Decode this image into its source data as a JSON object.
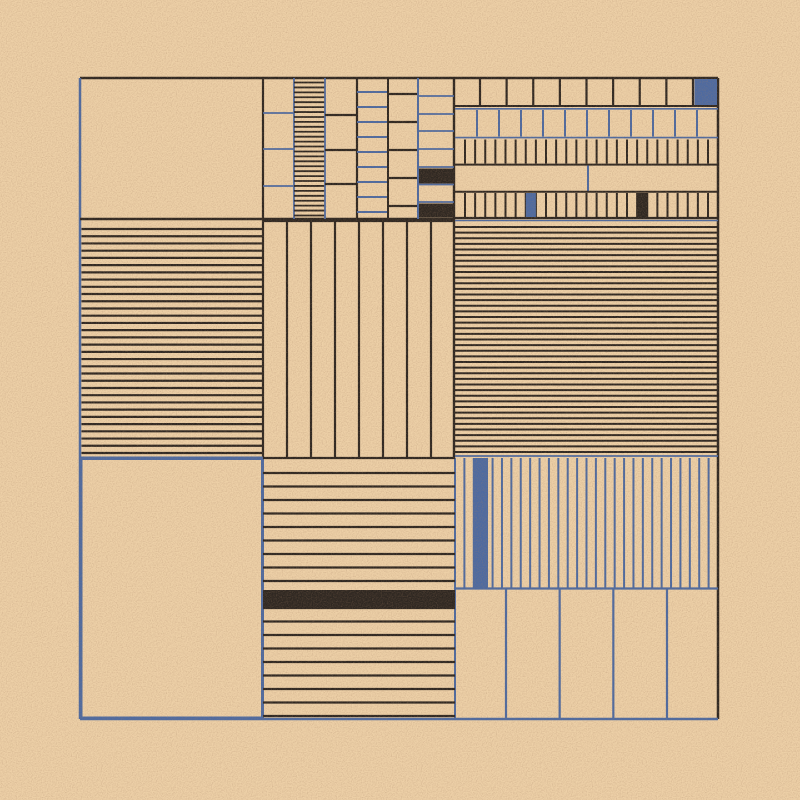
{
  "artwork": {
    "title": "generative-grid-composition",
    "width": 800,
    "height": 800,
    "background": "#edd0a7",
    "palette": {
      "ink": "#2e2721",
      "blue": "#4d6aa1",
      "bg": "#edd0a7"
    },
    "noise": {
      "base_frequency": 0.8,
      "opacity": 0.5
    },
    "shapes": [
      {
        "type": "line",
        "x1": 80,
        "y1": 78,
        "x2": 718,
        "y2": 78,
        "color": "ink",
        "t": 2.5
      },
      {
        "type": "line",
        "x1": 80,
        "y1": 78,
        "x2": 80,
        "y2": 719,
        "color": "blue",
        "t": 2.5
      },
      {
        "type": "line",
        "x1": 718,
        "y1": 78,
        "x2": 718,
        "y2": 719,
        "color": "ink",
        "t": 2.5
      },
      {
        "type": "line",
        "x1": 80,
        "y1": 719,
        "x2": 718,
        "y2": 719,
        "color": "blue",
        "t": 2.5
      },
      {
        "type": "line",
        "x1": 263,
        "y1": 78,
        "x2": 263,
        "y2": 458,
        "color": "ink",
        "t": 2.2
      },
      {
        "type": "line",
        "x1": 263,
        "y1": 458,
        "x2": 263,
        "y2": 719,
        "color": "blue",
        "t": 2
      },
      {
        "type": "line",
        "x1": 454,
        "y1": 78,
        "x2": 454,
        "y2": 458,
        "color": "ink",
        "t": 2.4
      },
      {
        "type": "line",
        "x1": 455,
        "y1": 458,
        "x2": 455,
        "y2": 719,
        "color": "blue",
        "t": 2
      },
      {
        "type": "line",
        "x1": 80,
        "y1": 219,
        "x2": 455,
        "y2": 219,
        "color": "ink",
        "t": 2.5
      },
      {
        "type": "line",
        "x1": 455,
        "y1": 218,
        "x2": 718,
        "y2": 218,
        "color": "ink",
        "t": 2.2
      },
      {
        "type": "line",
        "x1": 455,
        "y1": 220.5,
        "x2": 718,
        "y2": 220.5,
        "color": "blue",
        "t": 1.6
      },
      {
        "type": "line",
        "x1": 80,
        "y1": 457.5,
        "x2": 263,
        "y2": 457.5,
        "color": "blue",
        "t": 2
      },
      {
        "type": "line",
        "x1": 263,
        "y1": 458,
        "x2": 455,
        "y2": 458,
        "color": "ink",
        "t": 2.2
      },
      {
        "type": "line",
        "x1": 455,
        "y1": 456,
        "x2": 718,
        "y2": 456,
        "color": "blue",
        "t": 1.8
      },
      {
        "type": "rect",
        "x": 81.5,
        "y": 459,
        "w": 180.5,
        "h": 258.5,
        "stroke": "blue",
        "t": 2
      },
      {
        "type": "hlines",
        "x": 263,
        "w": 31,
        "ys": [
          113,
          149,
          186
        ],
        "color": "blue",
        "t": 1.8
      },
      {
        "type": "line",
        "x1": 294,
        "y1": 78,
        "x2": 294,
        "y2": 219,
        "color": "blue",
        "t": 1.8
      },
      {
        "type": "hlines",
        "x": 294,
        "w": 31,
        "from": 82.5,
        "to": 215.5,
        "count": 28,
        "color": "ink",
        "t": 1.8
      },
      {
        "type": "line",
        "x1": 325,
        "y1": 78,
        "x2": 325,
        "y2": 219,
        "color": "blue",
        "t": 1.8
      },
      {
        "type": "hlines",
        "x": 325,
        "w": 32,
        "ys": [
          115,
          150,
          184
        ],
        "color": "ink",
        "t": 2.2
      },
      {
        "type": "line",
        "x1": 357,
        "y1": 78,
        "x2": 357,
        "y2": 219,
        "color": "ink",
        "t": 2.2
      },
      {
        "type": "hlines",
        "x": 357,
        "w": 31,
        "from": 92,
        "to": 212,
        "count": 9,
        "color": "blue",
        "t": 2
      },
      {
        "type": "line",
        "x1": 388,
        "y1": 78,
        "x2": 388,
        "y2": 219,
        "color": "ink",
        "t": 2
      },
      {
        "type": "hlines",
        "x": 388,
        "w": 30,
        "ys": [
          94,
          122,
          150,
          178,
          206
        ],
        "color": "ink",
        "t": 2.2
      },
      {
        "type": "line",
        "x1": 418,
        "y1": 78,
        "x2": 418,
        "y2": 219,
        "color": "blue",
        "t": 2
      },
      {
        "type": "hlines",
        "x": 418,
        "w": 36,
        "ys": [
          96,
          114,
          131,
          149,
          167,
          184.5,
          202
        ],
        "color": "blue",
        "t": 1.8
      },
      {
        "type": "rect",
        "x": 419,
        "y": 168.5,
        "w": 34,
        "h": 15,
        "fill": "ink"
      },
      {
        "type": "rect",
        "x": 419,
        "y": 203.5,
        "w": 34,
        "h": 14,
        "fill": "ink"
      },
      {
        "type": "vlines",
        "y": 79,
        "h": 26.5,
        "from": 480,
        "to": 693,
        "count": 9,
        "color": "ink",
        "t": 2.2
      },
      {
        "type": "rect",
        "x": 694.5,
        "y": 79,
        "w": 22.5,
        "h": 26,
        "fill": "blue"
      },
      {
        "type": "line",
        "x1": 455,
        "y1": 106,
        "x2": 718,
        "y2": 106,
        "color": "ink",
        "t": 2
      },
      {
        "type": "line",
        "x1": 455,
        "y1": 108.8,
        "x2": 718,
        "y2": 108.8,
        "color": "blue",
        "t": 1.6
      },
      {
        "type": "vlines",
        "y": 110,
        "h": 26.5,
        "from": 477,
        "to": 697,
        "count": 11,
        "color": "blue",
        "t": 2
      },
      {
        "type": "line",
        "x1": 455,
        "y1": 137.6,
        "x2": 718,
        "y2": 137.6,
        "color": "blue",
        "t": 1.6
      },
      {
        "type": "vlines",
        "y": 139.5,
        "h": 24,
        "from": 465,
        "to": 708,
        "count": 25,
        "color": "ink",
        "t": 2
      },
      {
        "type": "line",
        "x1": 455,
        "y1": 164.6,
        "x2": 718,
        "y2": 164.6,
        "color": "ink",
        "t": 2
      },
      {
        "type": "line",
        "x1": 588,
        "y1": 165.5,
        "x2": 588,
        "y2": 191,
        "color": "blue",
        "t": 2
      },
      {
        "type": "line",
        "x1": 455,
        "y1": 191.8,
        "x2": 718,
        "y2": 191.8,
        "color": "ink",
        "t": 2
      },
      {
        "type": "vlines",
        "y": 193,
        "h": 24,
        "from": 465,
        "to": 708,
        "count": 25,
        "color": "ink",
        "t": 2
      },
      {
        "type": "rect",
        "x": 525.8,
        "y": 193,
        "w": 10.1,
        "h": 24,
        "fill": "blue"
      },
      {
        "type": "rect",
        "x": 637.1,
        "y": 193,
        "w": 10.1,
        "h": 24,
        "fill": "ink"
      },
      {
        "type": "hlines",
        "x": 81.5,
        "w": 181.5,
        "from": 229,
        "to": 453,
        "count": 32,
        "color": "ink",
        "t": 2.2
      },
      {
        "type": "line",
        "x1": 263,
        "y1": 221,
        "x2": 455,
        "y2": 221,
        "color": "ink",
        "t": 2.2
      },
      {
        "type": "vlines",
        "y": 221,
        "h": 237,
        "from": 287,
        "to": 431,
        "count": 7,
        "color": "ink",
        "t": 2.2
      },
      {
        "type": "hlines",
        "x": 455,
        "w": 263,
        "from": 227,
        "to": 452,
        "count": 41,
        "color": "ink",
        "t": 2
      },
      {
        "type": "hlines",
        "x": 263,
        "w": 192,
        "from": 473,
        "to": 716,
        "count": 19,
        "color": "ink",
        "t": 2.2
      },
      {
        "type": "rect",
        "x": 263,
        "y": 590,
        "w": 192,
        "h": 18,
        "fill": "ink"
      },
      {
        "type": "vlines",
        "y": 458,
        "h": 130,
        "from": 464.4,
        "to": 708.6,
        "count": 27,
        "color": "blue",
        "t": 2
      },
      {
        "type": "rect",
        "x": 474,
        "y": 458,
        "w": 14,
        "h": 130,
        "fill": "blue"
      },
      {
        "type": "line",
        "x1": 455,
        "y1": 588.5,
        "x2": 718,
        "y2": 588.5,
        "color": "blue",
        "t": 2.2
      },
      {
        "type": "vlines",
        "y": 589.5,
        "h": 129.5,
        "from": 506,
        "to": 667,
        "count": 4,
        "color": "blue",
        "t": 2.2
      }
    ]
  }
}
